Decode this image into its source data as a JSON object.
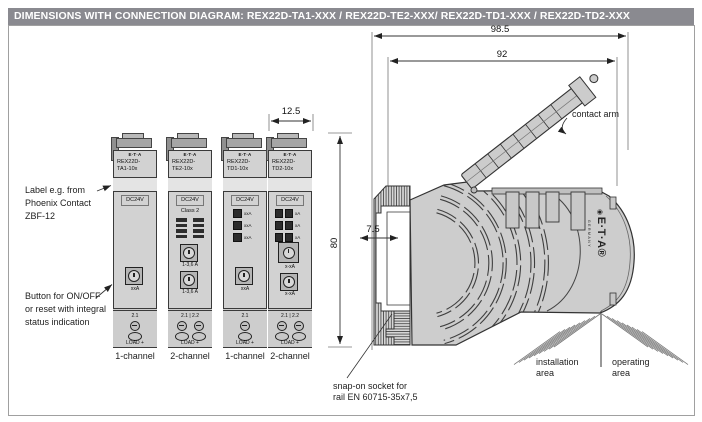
{
  "header": {
    "title": "DIMENSIONS WITH CONNECTION DIAGRAM: REX22D-TA1-XXX / REX22D-TE2-XXX/ REX22D-TD1-XXX / REX22D-TD2-XXX"
  },
  "colors": {
    "header_bg": "#8a8a90",
    "header_text": "#ffffff",
    "module_body": "#d2d2d2",
    "outline": "#3a3a3a"
  },
  "icons": {
    "eta_mark": "◉"
  },
  "notes": {
    "label_note": "Label e.g. from Phoenix Contact ZBF-12",
    "button_note": "Button for ON/OFF or reset with integral status indication"
  },
  "dims": {
    "overall_width": "98.5",
    "inner_width": "92",
    "module_width": "12.5",
    "height": "80",
    "rail_depth": "7.5"
  },
  "side_view": {
    "contact_arm": "contact arm",
    "snap_line1": "snap-on socket for",
    "snap_line2": "rail EN 60715-35x7,5",
    "install_line1": "installation",
    "install_line2": "area",
    "operate_line1": "operating",
    "operate_line2": "area",
    "brand": "E·T·A®",
    "brand_country": "GERMANY"
  },
  "modules": [
    {
      "brand": "E·T·A",
      "model_line1": "REX22D-",
      "model_line2": "TA1-10x",
      "voltage": "DC24V",
      "button1_label": "xxA",
      "terminal_label": "2.1",
      "load_label": "LOAD +",
      "channel": "1-channel"
    },
    {
      "brand": "E·T·A",
      "model_line1": "REX22D-",
      "model_line2": "TE2-10x",
      "voltage": "DC24V",
      "class_label": "Class 2",
      "button1_label": "1-3,6 A",
      "button2_label": "1-3,6 A",
      "terminal_label": "2.1 | 2.2",
      "load_label": "LOAD +",
      "channel": "2-channel"
    },
    {
      "brand": "E·T·A",
      "model_line1": "REX22D-",
      "model_line2": "TD1-10x",
      "voltage": "DC24V",
      "led_labels": [
        "xxA",
        "xxA",
        "xxA"
      ],
      "button1_label": "xxA",
      "terminal_label": "2.1",
      "load_label": "LOAD +",
      "channel": "1-channel"
    },
    {
      "brand": "E·T·A",
      "model_line1": "REX22D-",
      "model_line2": "TD2-10x",
      "voltage": "DC24V",
      "led_labels": [
        "xA",
        "xA",
        "xA"
      ],
      "button1_label": "x-xA",
      "button2_label": "x-xA",
      "terminal_label": "2.1 | 2.2",
      "load_label": "LOAD +",
      "channel": "2-channel"
    }
  ]
}
